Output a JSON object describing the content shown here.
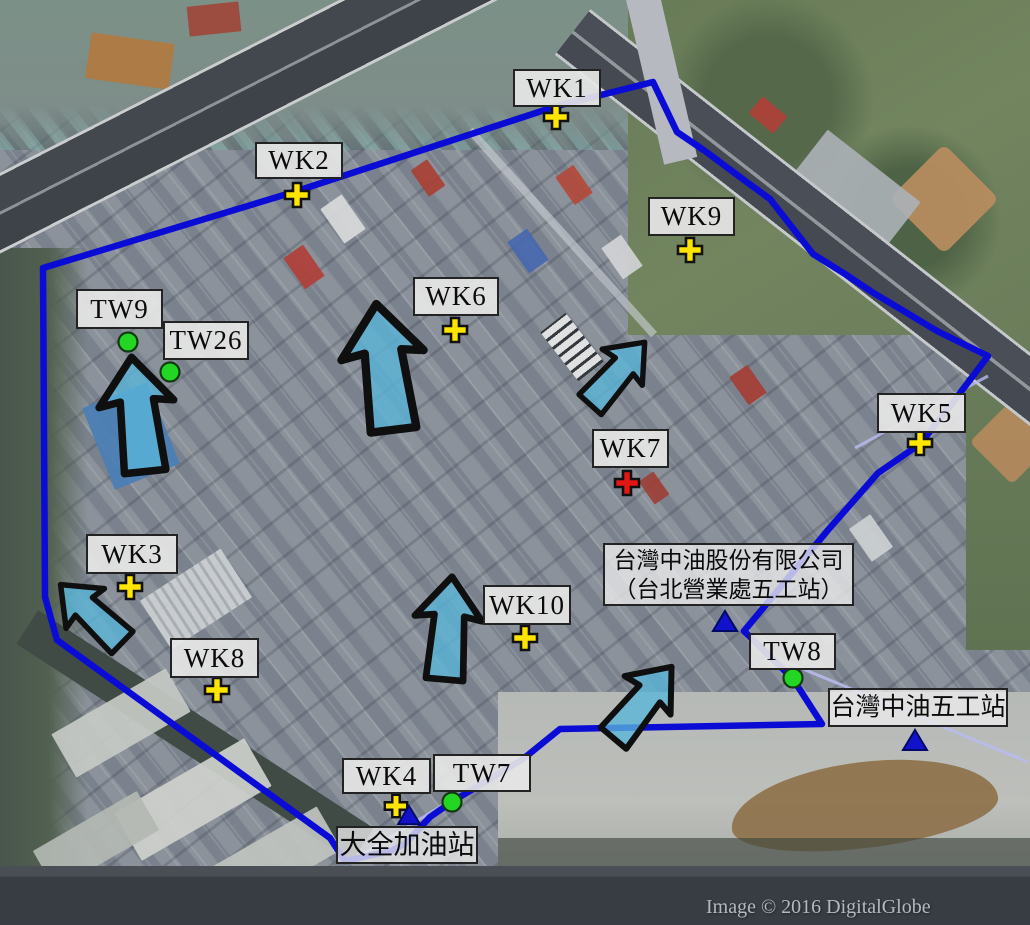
{
  "figure": {
    "attribution": "Image © 2016 DigitalGlobe"
  },
  "colors": {
    "boundary_line": "#0b0bd6",
    "flow_arrow_fill": "#58b6da",
    "monitoring_well_cross": "#ffe500",
    "wk7_cross": "#e31515",
    "tw_well_circle": "#24d624",
    "station_triangle": "#1212cc",
    "callout_background": "#e6e6e6",
    "leader_line": "#b9bcf0"
  },
  "callouts": {
    "wk1": "WK1",
    "wk2": "WK2",
    "wk3": "WK3",
    "wk4": "WK4",
    "wk5": "WK5",
    "wk6": "WK6",
    "wk7": "WK7",
    "wk8": "WK8",
    "wk9": "WK9",
    "wk10": "WK10",
    "tw7": "TW7",
    "tw8": "TW8",
    "tw9": "TW9",
    "tw26": "TW26",
    "cpc_main_line1": "台灣中油股份有限公司",
    "cpc_main_line2": "（台北營業處五工站）",
    "cpc_wugong": "台灣中油五工站",
    "daquan": "大全加油站"
  }
}
